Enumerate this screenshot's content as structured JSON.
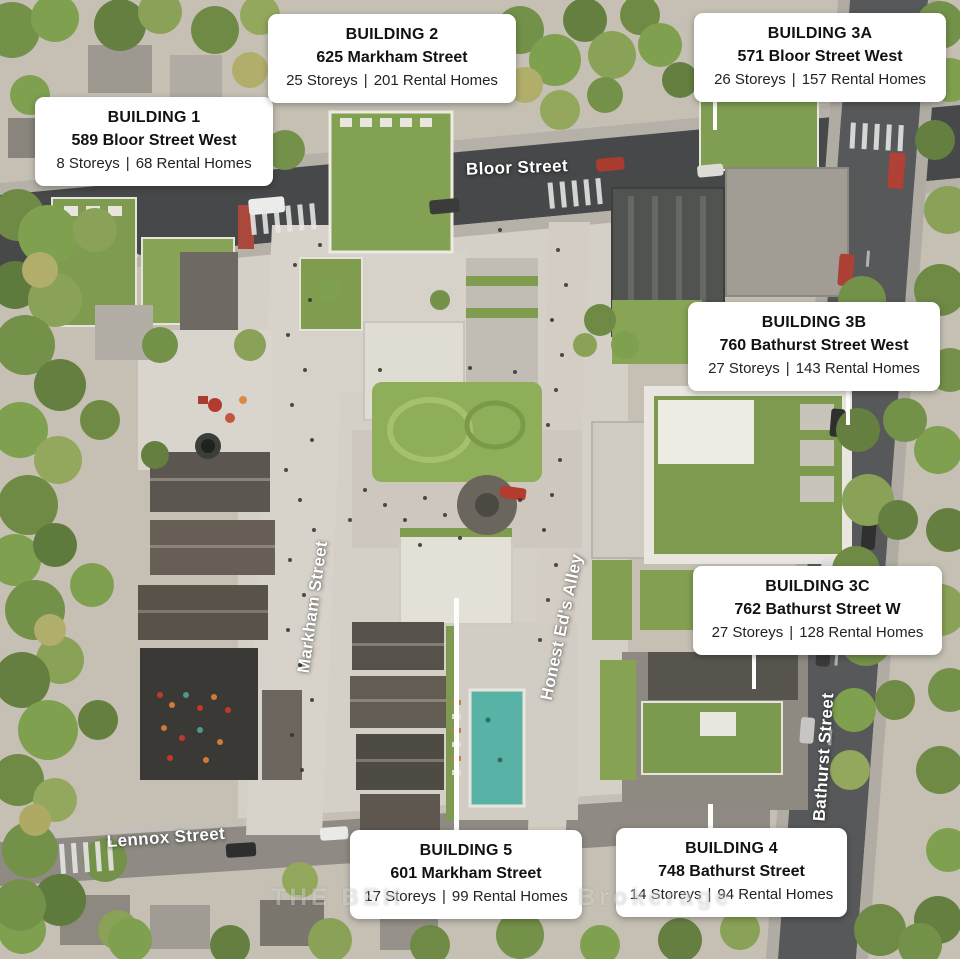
{
  "separator": "|",
  "callouts": [
    {
      "id": "building-1",
      "title": "BUILDING 1",
      "address": "589 Bloor Street West",
      "storeys": "8 Storeys",
      "homes": "68 Rental Homes"
    },
    {
      "id": "building-2",
      "title": "BUILDING 2",
      "address": "625 Markham Street",
      "storeys": "25 Storeys",
      "homes": "201 Rental Homes"
    },
    {
      "id": "building-3a",
      "title": "BUILDING 3A",
      "address": "571 Bloor Street West",
      "storeys": "26 Storeys",
      "homes": "157 Rental Homes"
    },
    {
      "id": "building-3b",
      "title": "BUILDING 3B",
      "address": "760 Bathurst Street West",
      "storeys": "27 Storeys",
      "homes": "143 Rental Homes"
    },
    {
      "id": "building-3c",
      "title": "BUILDING 3C",
      "address": "762 Bathurst Street W",
      "storeys": "27 Storeys",
      "homes": "128 Rental Homes"
    },
    {
      "id": "building-5",
      "title": "BUILDING 5",
      "address": "601 Markham Street",
      "storeys": "17 Storeys",
      "homes": "99 Rental Homes"
    },
    {
      "id": "building-4",
      "title": "BUILDING 4",
      "address": "748 Bathurst Street",
      "storeys": "14 Storeys",
      "homes": "94 Rental Homes"
    }
  ],
  "streets": {
    "bloor": "Bloor Street",
    "markham": "Markham Street",
    "honest_eds": "Honest Ed's Alley",
    "bathurst": "Bathurst Street",
    "lennox": "Lennox Street"
  },
  "watermark": {
    "left": "THE BEH",
    "right": "Brokerage"
  },
  "colors": {
    "callout_bg": "#ffffff",
    "callout_text": "#121212",
    "callout_stats": "#232323",
    "street_label": "#ffffff",
    "tree_green": "#7d9a4e",
    "lawn_green": "#8fae5a",
    "road_dark": "#46484a",
    "paving": "#d5d0c7",
    "pool_teal": "#58b2a5"
  }
}
